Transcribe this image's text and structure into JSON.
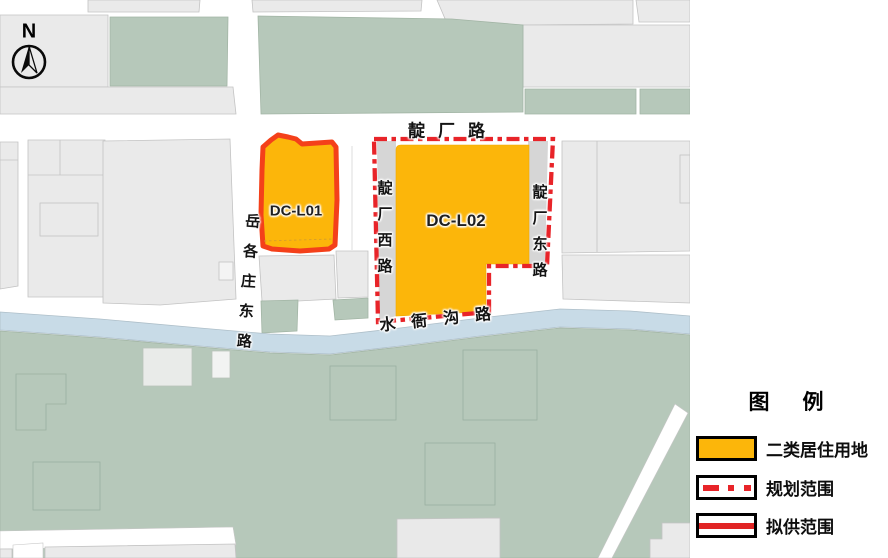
{
  "map": {
    "north_label": "N",
    "parcels": [
      {
        "id": "DC-L01"
      },
      {
        "id": "DC-L02"
      }
    ],
    "roads": {
      "dianchang_lu": "靛厂路",
      "dianchang_xi_lu": "靛厂西路",
      "dianchang_dong_lu": "靛厂东路",
      "yuegezhuang_dong_lu": "岳各庄东路",
      "shuiyagou_lu": "水衙沟路"
    }
  },
  "legend": {
    "title": "图　例",
    "items": [
      {
        "label": "二类居住用地"
      },
      {
        "label": "规划范围"
      },
      {
        "label": "拟供范围"
      }
    ]
  },
  "colors": {
    "residential_fill": "#fcb60a",
    "planning_boundary_red": "#e82429",
    "supply_boundary_red": "#f4401a",
    "green_block": "#b6c8ba",
    "canal_blue": "#c8dbe7",
    "parcel_gray": "#eaeaea"
  }
}
